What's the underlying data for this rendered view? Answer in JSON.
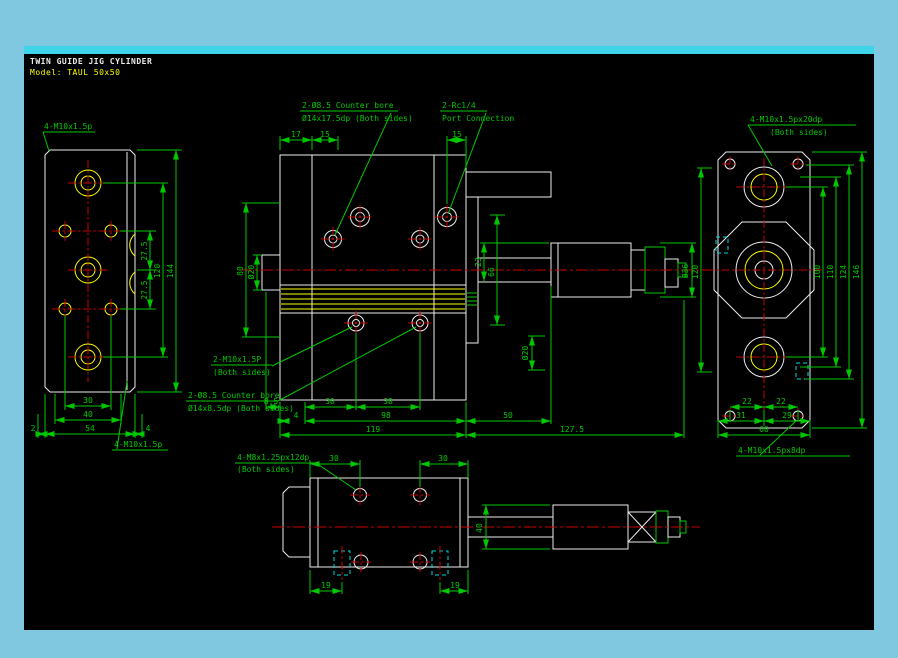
{
  "header": {
    "title": "TWIN GUIDE JIG CYLINDER",
    "model": "Model: TAUL 50x50"
  },
  "colors": {
    "frame_blue": "#7fc8e0",
    "frame_highlight": "#3fd4ea",
    "canvas_black": "#000000",
    "dimension_green": "#00c800",
    "object_white": "#ededed",
    "detail_yellow": "#ffff00",
    "centerline_red": "#c80000",
    "hidden_cyan": "#00dcdc"
  },
  "views": {
    "left": {
      "label_top": "4-M10x1.5p",
      "label_bottom": "4-M10x1.5p",
      "dim_pitch_top": "27.5",
      "dim_pitch_bottom": "27.5",
      "dim_120": "120",
      "dim_144": "144",
      "dim_30": "30",
      "dim_40": "40",
      "dim_54": "54",
      "dim_2": "2",
      "dim_4": "4"
    },
    "front": {
      "cbore_top_line1": "2-Ø8.5 Counter bore",
      "cbore_top_line2": "Ø14x17.5dp (Both sides)",
      "port_line1": "2-Rc1/4",
      "port_line2": "Port Connection",
      "dim_17": "17",
      "dim_15_left": "15",
      "dim_15_right": "15",
      "dim_80": "80",
      "dim_d20_rod": "Ø20",
      "dim_23": "23",
      "dim_66": "66",
      "dim_d36": "Ø36",
      "dim_d20_guide": "Ø20",
      "thread_line1": "2-M10x1.5P",
      "thread_line2": "(Both sides)",
      "cbore_bottom_line1": "2-Ø8.5 Counter bore",
      "cbore_bottom_line2": "Ø14x8.5dp (Both sides)",
      "dim_8_5": "8.5",
      "dim_4": "4",
      "dim_30": "30",
      "dim_38": "38",
      "dim_98": "98",
      "dim_50": "50",
      "dim_119": "119",
      "dim_127_5": "127.5"
    },
    "right": {
      "label_top_line1": "4-M10x1.5px20dp",
      "label_top_line2": "(Both sides)",
      "dim_120": "120",
      "dim_100": "100",
      "dim_110": "110",
      "dim_124": "124",
      "dim_146": "146",
      "dim_22_left": "22",
      "dim_22_right": "22",
      "dim_31": "31",
      "dim_29": "29",
      "dim_60": "60",
      "label_bottom": "4-M10x1.5px8dp"
    },
    "bottom": {
      "label_line1": "4-M8x1.25px12dp",
      "label_line2": "(Both sides)",
      "dim_30_left": "30",
      "dim_30_right": "30",
      "dim_40": "40",
      "dim_19_left": "19",
      "dim_19_right": "19"
    }
  }
}
